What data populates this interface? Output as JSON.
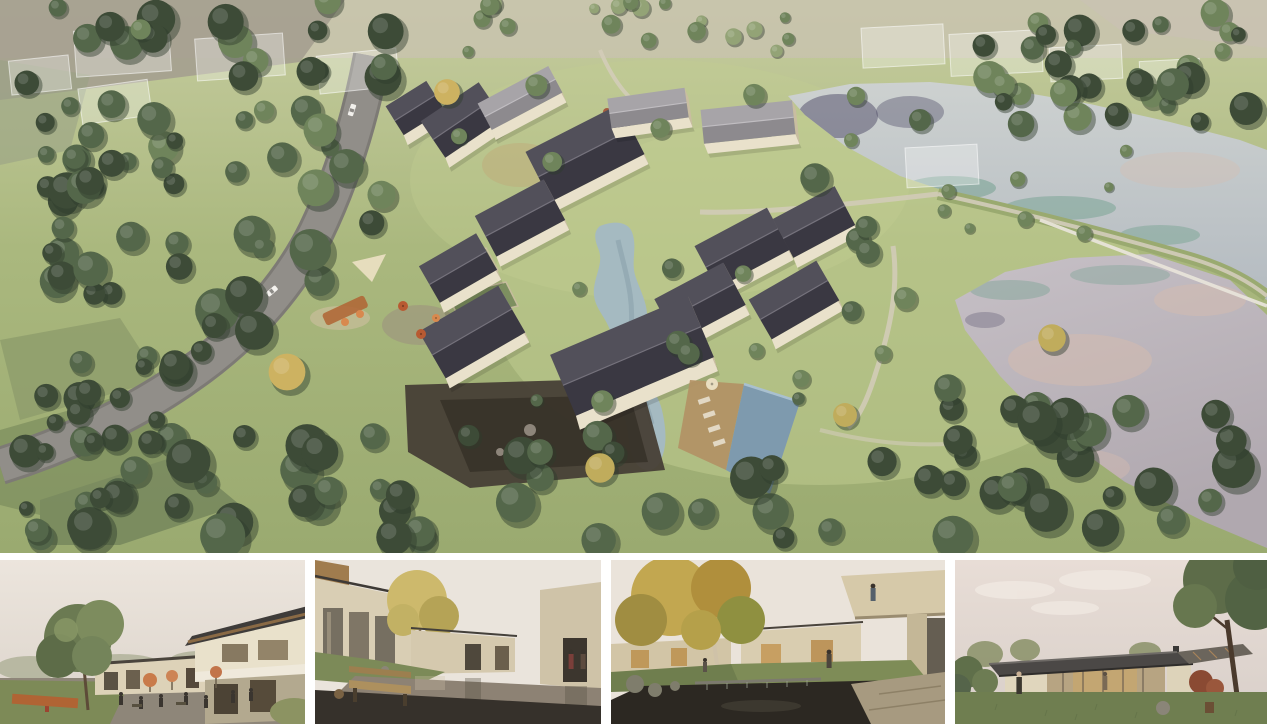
{
  "page": {
    "background": "#ffffff",
    "kind": "architectural rendering board"
  },
  "palette": {
    "white": "#ffffff",
    "grass_top": "#c6cc9f",
    "grass": "#aab87e",
    "grass_low": "#9aaa70",
    "lawn_hi": "#c2cd92",
    "haze": "#c9c2b2",
    "field_grey": "#a49e8f",
    "field_olive1": "#8d9b6b",
    "field_olive2": "#7e8f5f",
    "field_olive3": "#71825a",
    "tree_dark": "#3d4b37",
    "tree_mid": "#54674a",
    "tree_light": "#6f845b",
    "tree_pale": "#93a376",
    "tree_yellow": "#c0ac5c",
    "tree_gold": "#cdb261",
    "tree_shadow": "#2f3b2c",
    "road": "#918e89",
    "road_edge": "#7d7a75",
    "path": "#d3ccba",
    "lakeU_top": "#cdd1d0",
    "lakeU_bot": "#b4bbc1",
    "lakeR_top": "#c6c0c6",
    "lakeR_bot": "#b0a8af",
    "water_navy": "#4e4a66",
    "water_teal": "#74a18f",
    "water_pink": "#d6bcae",
    "stream": "#a5bac1",
    "stream_deep": "#8aa2ac",
    "pool": "#7e9aae",
    "pool_hi": "#a9c0cf",
    "roof_hi": "#52505a",
    "roof_lo": "#3a3842",
    "roof_ridge": "#75727c",
    "roofL_hi": "#a7a4a8",
    "roofL_lo": "#8d8a8e",
    "wall": "#e9e1cb",
    "wall_shade": "#c9bda1",
    "stone": "#473f36",
    "stone_deep": "#362f27",
    "deck": "#b29165",
    "lounger": "#e2d8c4",
    "corten": "#b06434",
    "orange": "#d8894e",
    "umbrella": "#b85a32",
    "canvas": "#e9dec1",
    "sand": "#cfc0a0",
    "warm": "#c2a878",
    "sky1": "#ece5dd",
    "sky2": "#dbd3ca"
  },
  "main_view": {
    "name": "aerial-masterplan-rendering",
    "alt": "Aerial rendering of a courtyard village resort with gabled houses, winding stream, swimming pool, tree belts, a country road and two lakes",
    "trees_seed": 11,
    "tree_clusters": [
      {
        "x": 0,
        "y": 0,
        "w": 150,
        "h": 300,
        "n": 26,
        "rmin": 9,
        "rmax": 20,
        "shades": [
          "dark",
          "mid"
        ]
      },
      {
        "x": 140,
        "y": 0,
        "w": 250,
        "h": 225,
        "n": 30,
        "rmin": 9,
        "rmax": 21,
        "shades": [
          "mid",
          "dark",
          "light"
        ]
      },
      {
        "x": 55,
        "y": 225,
        "w": 280,
        "h": 185,
        "n": 20,
        "rmin": 10,
        "rmax": 24,
        "shades": [
          "mid",
          "dark"
        ]
      },
      {
        "x": 25,
        "y": 435,
        "w": 940,
        "h": 108,
        "n": 48,
        "rmin": 11,
        "rmax": 25,
        "shades": [
          "dark",
          "mid"
        ]
      },
      {
        "x": 950,
        "y": 398,
        "w": 315,
        "h": 148,
        "n": 26,
        "rmin": 11,
        "rmax": 24,
        "shades": [
          "dark",
          "mid"
        ]
      },
      {
        "x": 980,
        "y": 12,
        "w": 285,
        "h": 112,
        "n": 32,
        "rmin": 8,
        "rmax": 18,
        "shades": [
          "mid",
          "dark",
          "light"
        ]
      },
      {
        "x": 430,
        "y": 0,
        "w": 360,
        "h": 52,
        "n": 20,
        "rmin": 5,
        "rmax": 11,
        "shades": [
          "light",
          "pale"
        ]
      },
      {
        "x": 940,
        "y": 150,
        "w": 190,
        "h": 85,
        "n": 8,
        "rmin": 5,
        "rmax": 9,
        "shades": [
          "light"
        ]
      },
      {
        "x": 430,
        "y": 85,
        "w": 460,
        "h": 320,
        "n": 20,
        "rmin": 6,
        "rmax": 13,
        "shades": [
          "mid",
          "light"
        ]
      },
      {
        "x": 0,
        "y": 330,
        "w": 190,
        "h": 190,
        "n": 12,
        "rmin": 7,
        "rmax": 14,
        "shades": [
          "dark"
        ]
      }
    ],
    "single_trees": [
      {
        "x": 815,
        "y": 178,
        "r": 16,
        "s": "mid"
      },
      {
        "x": 868,
        "y": 252,
        "r": 13,
        "s": "mid"
      },
      {
        "x": 905,
        "y": 298,
        "r": 12,
        "s": "light"
      },
      {
        "x": 948,
        "y": 388,
        "r": 15,
        "s": "mid"
      },
      {
        "x": 845,
        "y": 415,
        "r": 13,
        "s": "yellow"
      },
      {
        "x": 600,
        "y": 468,
        "r": 16,
        "s": "yellow"
      },
      {
        "x": 447,
        "y": 92,
        "r": 14,
        "s": "gold"
      },
      {
        "x": 1052,
        "y": 338,
        "r": 15,
        "s": "yellow"
      },
      {
        "x": 287,
        "y": 372,
        "r": 20,
        "s": "gold"
      },
      {
        "x": 540,
        "y": 452,
        "r": 14,
        "s": "mid"
      },
      {
        "x": 772,
        "y": 468,
        "r": 14,
        "s": "dark"
      },
      {
        "x": 958,
        "y": 440,
        "r": 16,
        "s": "dark"
      },
      {
        "x": 920,
        "y": 120,
        "r": 12,
        "s": "mid"
      },
      {
        "x": 856,
        "y": 96,
        "r": 10,
        "s": "light"
      }
    ],
    "houses": [
      {
        "x": 415,
        "y": 108,
        "l": 48,
        "w": 34,
        "a": -32,
        "roof": "dark"
      },
      {
        "x": 462,
        "y": 120,
        "l": 70,
        "w": 44,
        "a": -34,
        "roof": "dark"
      },
      {
        "x": 520,
        "y": 98,
        "l": 80,
        "w": 30,
        "a": -28,
        "roof": "light"
      },
      {
        "x": 585,
        "y": 153,
        "l": 105,
        "w": 56,
        "a": -27,
        "roof": "dark"
      },
      {
        "x": 648,
        "y": 108,
        "l": 78,
        "w": 30,
        "a": -8,
        "roof": "light"
      },
      {
        "x": 748,
        "y": 122,
        "l": 92,
        "w": 34,
        "a": -6,
        "roof": "light"
      },
      {
        "x": 520,
        "y": 218,
        "l": 78,
        "w": 46,
        "a": -28,
        "roof": "dark"
      },
      {
        "x": 458,
        "y": 268,
        "l": 66,
        "w": 42,
        "a": -30,
        "roof": "dark"
      },
      {
        "x": 472,
        "y": 332,
        "l": 92,
        "w": 54,
        "a": -30,
        "roof": "dark"
      },
      {
        "x": 742,
        "y": 248,
        "l": 82,
        "w": 48,
        "a": -28,
        "roof": "dark"
      },
      {
        "x": 814,
        "y": 222,
        "l": 70,
        "w": 44,
        "a": -28,
        "roof": "dark"
      },
      {
        "x": 700,
        "y": 302,
        "l": 78,
        "w": 48,
        "a": -28,
        "roof": "dark"
      },
      {
        "x": 794,
        "y": 300,
        "l": 78,
        "w": 46,
        "a": -30,
        "roof": "dark"
      },
      {
        "x": 632,
        "y": 356,
        "l": 150,
        "w": 66,
        "a": -23,
        "roof": "dark"
      }
    ],
    "cars": [
      {
        "x": 352,
        "y": 110,
        "a": -72,
        "c": "#f2f0ec"
      },
      {
        "x": 348,
        "y": 162,
        "a": -76,
        "c": "#d8d6d2"
      },
      {
        "x": 272,
        "y": 291,
        "a": -40,
        "c": "#f4f2ee"
      },
      {
        "x": 201,
        "y": 351,
        "a": -38,
        "c": "#cfccc8"
      }
    ],
    "ghost_buildings": [
      {
        "x": 75,
        "y": 28,
        "w": 95,
        "h": 46,
        "a": -4
      },
      {
        "x": 196,
        "y": 36,
        "w": 88,
        "h": 42,
        "a": -4
      },
      {
        "x": 318,
        "y": 52,
        "w": 80,
        "h": 38,
        "a": -6
      },
      {
        "x": 80,
        "y": 84,
        "w": 70,
        "h": 36,
        "a": -8
      },
      {
        "x": 10,
        "y": 58,
        "w": 60,
        "h": 34,
        "a": -6
      },
      {
        "x": 862,
        "y": 26,
        "w": 82,
        "h": 40,
        "a": -3
      },
      {
        "x": 950,
        "y": 32,
        "w": 92,
        "h": 42,
        "a": -3
      },
      {
        "x": 1050,
        "y": 46,
        "w": 72,
        "h": 34,
        "a": -3
      },
      {
        "x": 906,
        "y": 146,
        "w": 72,
        "h": 40,
        "a": -3
      },
      {
        "x": 1140,
        "y": 60,
        "w": 60,
        "h": 30,
        "a": -3
      }
    ],
    "umbrellas": [
      {
        "x": 403,
        "y": 306,
        "r": 5,
        "c": "umbrella"
      },
      {
        "x": 421,
        "y": 334,
        "r": 5,
        "c": "umbrella"
      },
      {
        "x": 436,
        "y": 318,
        "r": 4,
        "c": "orange"
      },
      {
        "x": 712,
        "y": 384,
        "r": 6,
        "c": "canvas"
      }
    ]
  },
  "thumbnails": [
    {
      "name": "plaza-cafe-rendering",
      "alt": "Village plaza with cafe seating, umbrellas and a two-storey timber-roofed building"
    },
    {
      "name": "reflecting-pool-courtyard-rendering",
      "alt": "Courtyard reflecting pool with wooden bench and cream buildings"
    },
    {
      "name": "garden-pond-terrace-rendering",
      "alt": "Garden pond with stone weir, autumn tree and cantilevered balcony"
    },
    {
      "name": "glass-pavilion-lawn-rendering",
      "alt": "Single-storey glass pavilion on a lawn at dusk under a large tree"
    }
  ]
}
